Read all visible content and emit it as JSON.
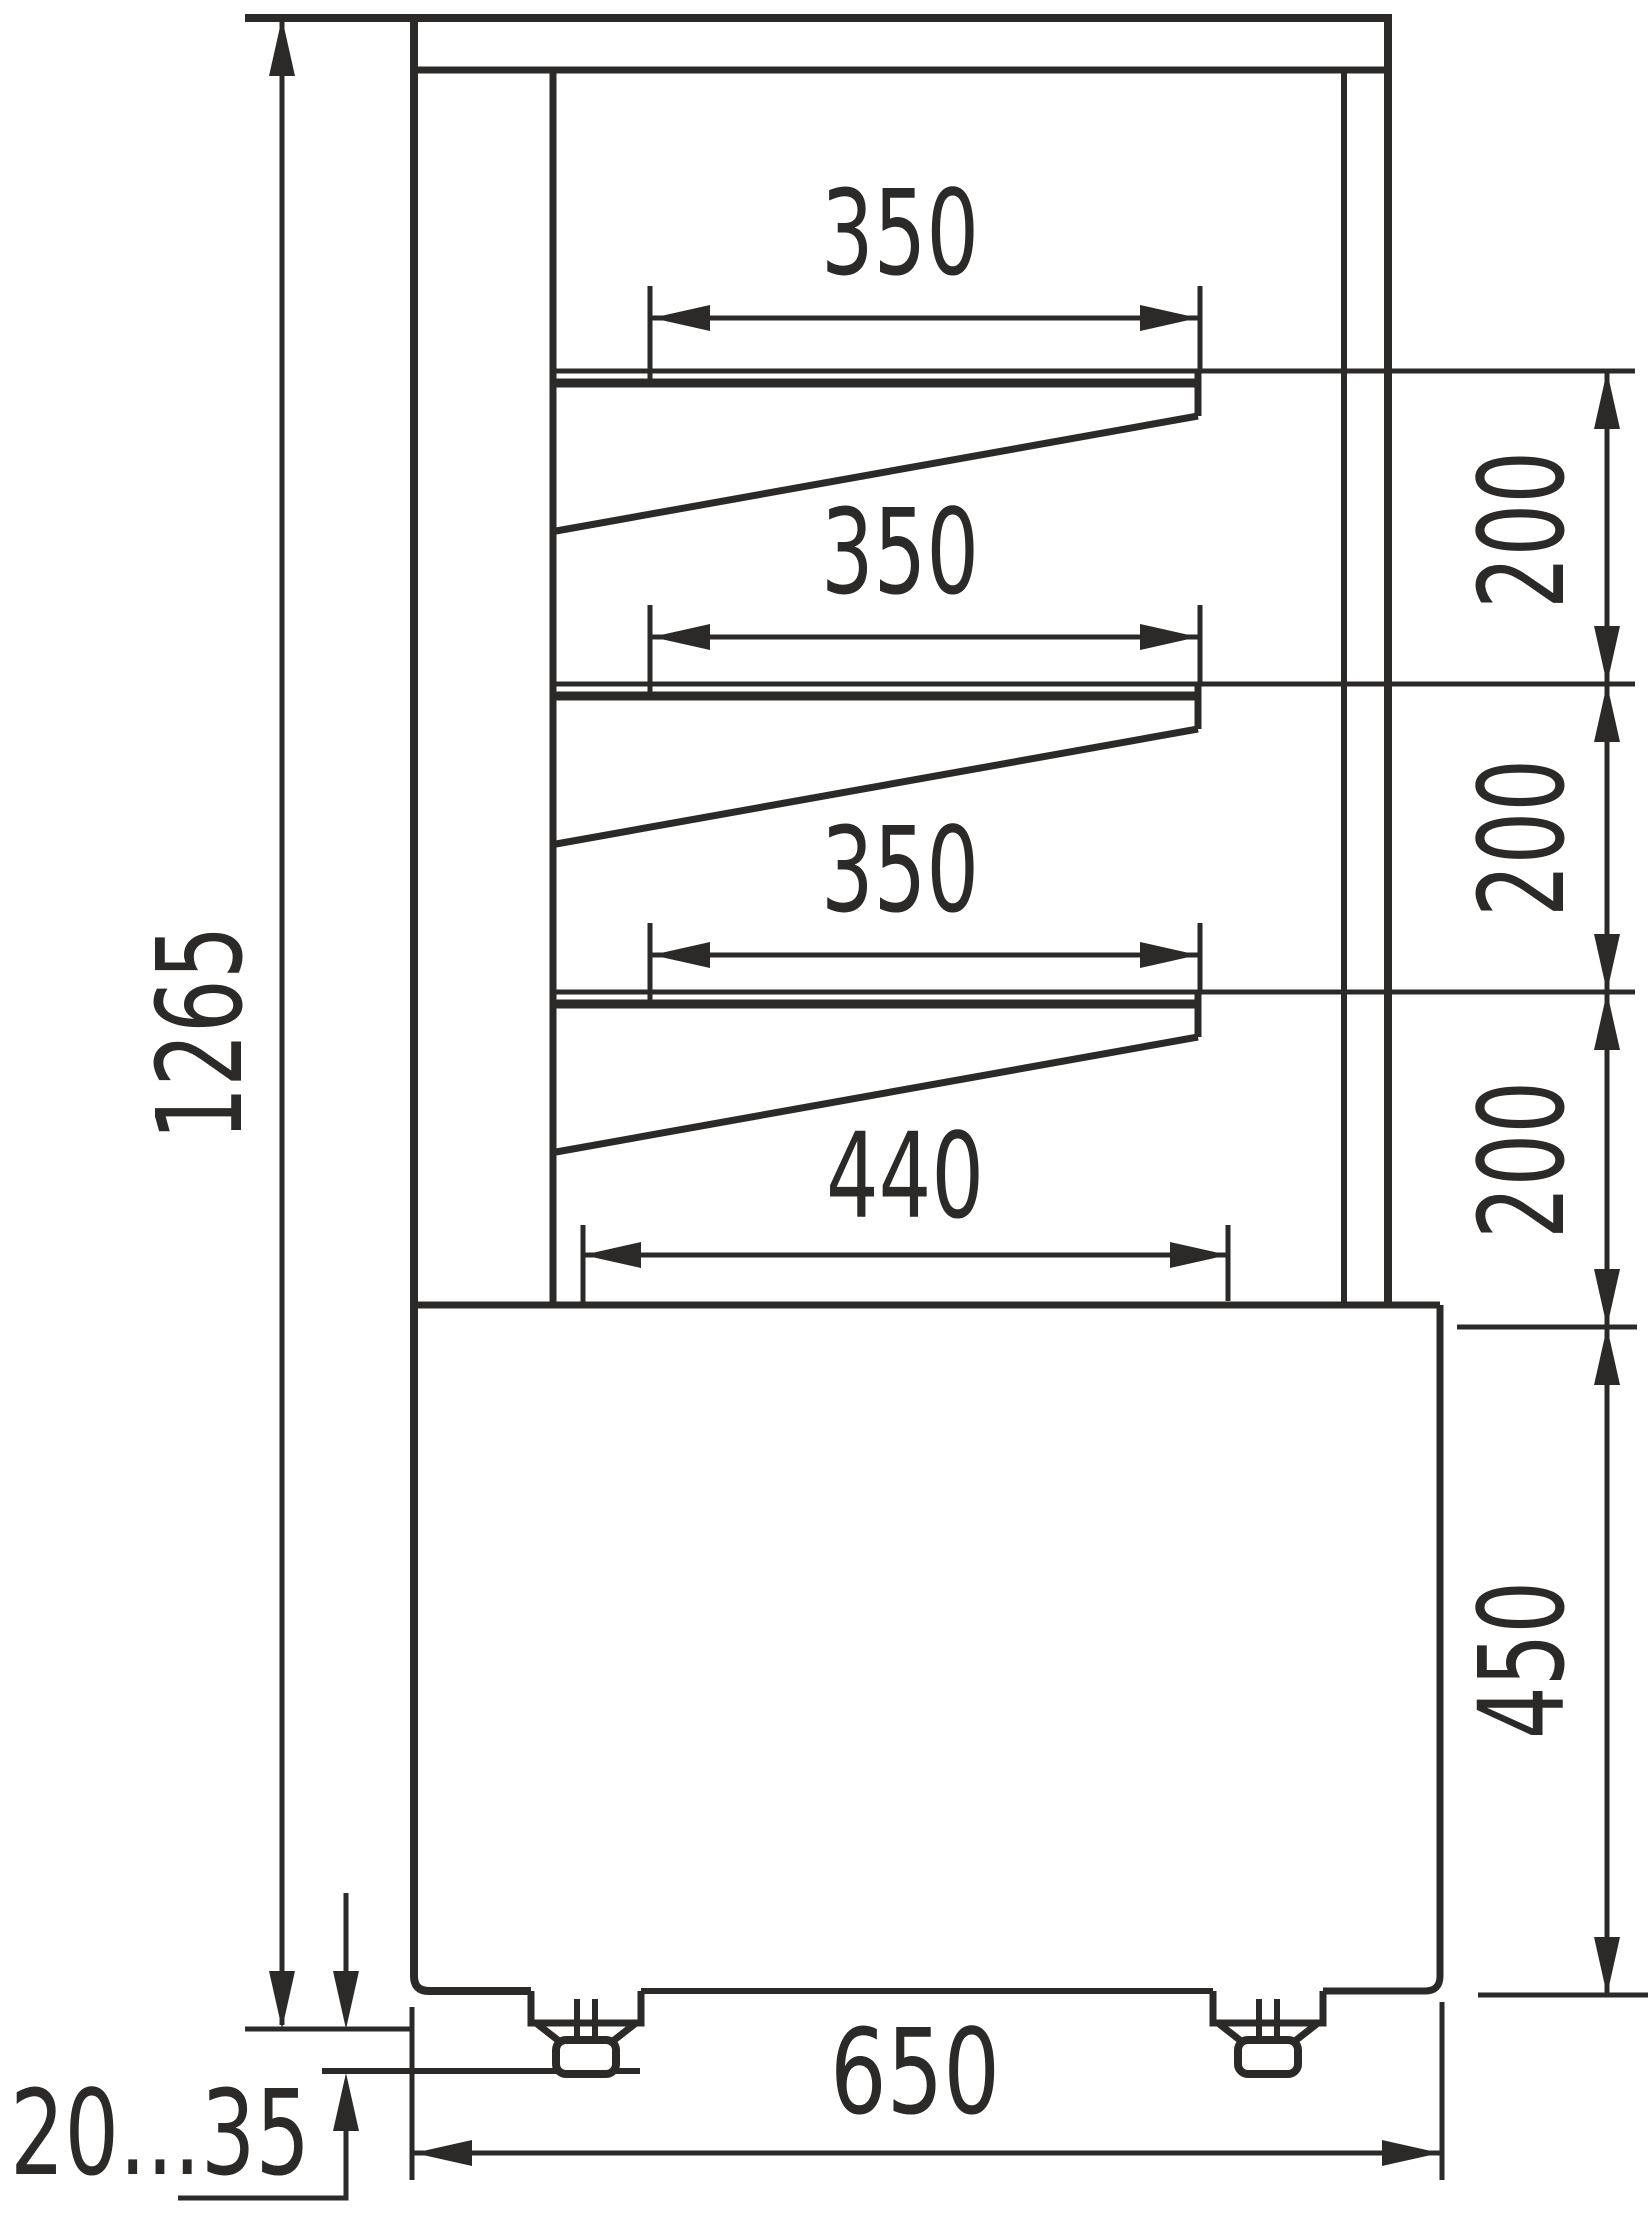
{
  "drawing": {
    "kind": "technical dimension drawing",
    "view": "side cross-section of refrigerated pastry display case",
    "units": "mm",
    "ink_color": "#2b2a29",
    "background_color": "#ffffff",
    "labels": {
      "overall_height": "1265",
      "shelf1_depth": "350",
      "shelf2_depth": "350",
      "shelf3_depth": "350",
      "bottom_shelf_depth": "440",
      "shelf_gap_1": "200",
      "shelf_gap_2": "200",
      "shelf_gap_3": "200",
      "base_height": "450",
      "overall_depth": "650",
      "foot_adjust_range": "20...35"
    }
  }
}
